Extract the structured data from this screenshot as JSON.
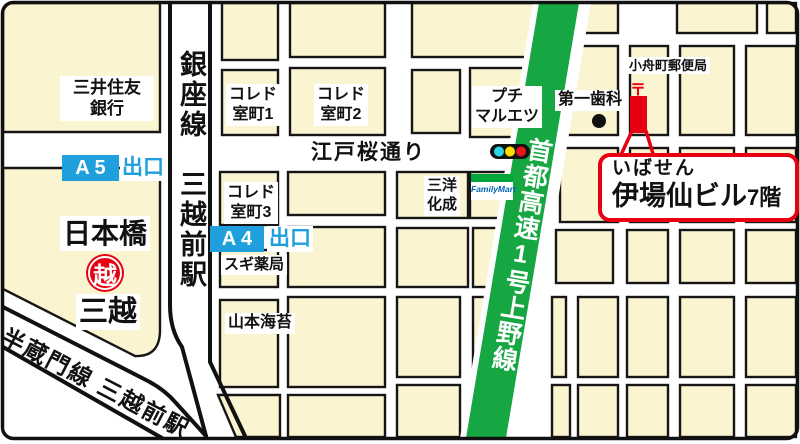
{
  "colors": {
    "block_fill": "#FAF4D0",
    "expressway_green": "#16A743",
    "badge_blue": "#1FA0DC",
    "accent_red": "#E60012",
    "familymart_green": "#00A63C",
    "familymart_blue": "#0063B5",
    "signal_cyan": "#29D8E8",
    "signal_yellow": "#FFDD00",
    "signal_red": "#E8131D"
  },
  "stations": {
    "ginza_line": "銀座線　三越前駅",
    "hanzomon_line": "半蔵門線 三越前駅"
  },
  "exits": {
    "a5": {
      "code": "A 5",
      "label": "出口"
    },
    "a4": {
      "code": "A 4",
      "label": "出口"
    }
  },
  "roads": {
    "edo_sakura": "江戸桜通り",
    "expressway": "首都高速1号上野線"
  },
  "places": {
    "smbc_bank": {
      "line1": "三井住友",
      "line2": "銀行"
    },
    "nihombashi": "日本橋",
    "mitsukoshi": "三越",
    "mitsukoshi_logo_glyph": "越",
    "coredo_muromachi_1": {
      "line1": "コレド",
      "line2": "室町1"
    },
    "coredo_muromachi_2": {
      "line1": "コレド",
      "line2": "室町2"
    },
    "coredo_muromachi_3": {
      "line1": "コレド",
      "line2": "室町3"
    },
    "sugi_pharmacy": "スギ薬局",
    "yamamoto_nori": "山本海苔",
    "petit_maruetsu": {
      "line1": "プチ",
      "line2": "マルエツ"
    },
    "sanyo_kasei": {
      "line1": "三洋",
      "line2": "化成"
    },
    "familymart": "FamilyMart",
    "daiichi_dental": "第一歯科",
    "kofunacho_post_office": "小舟町郵便局",
    "post_mark": "〒"
  },
  "destination": {
    "furigana": "いばせん",
    "name": "伊場仙ビル",
    "floor": "7階"
  }
}
